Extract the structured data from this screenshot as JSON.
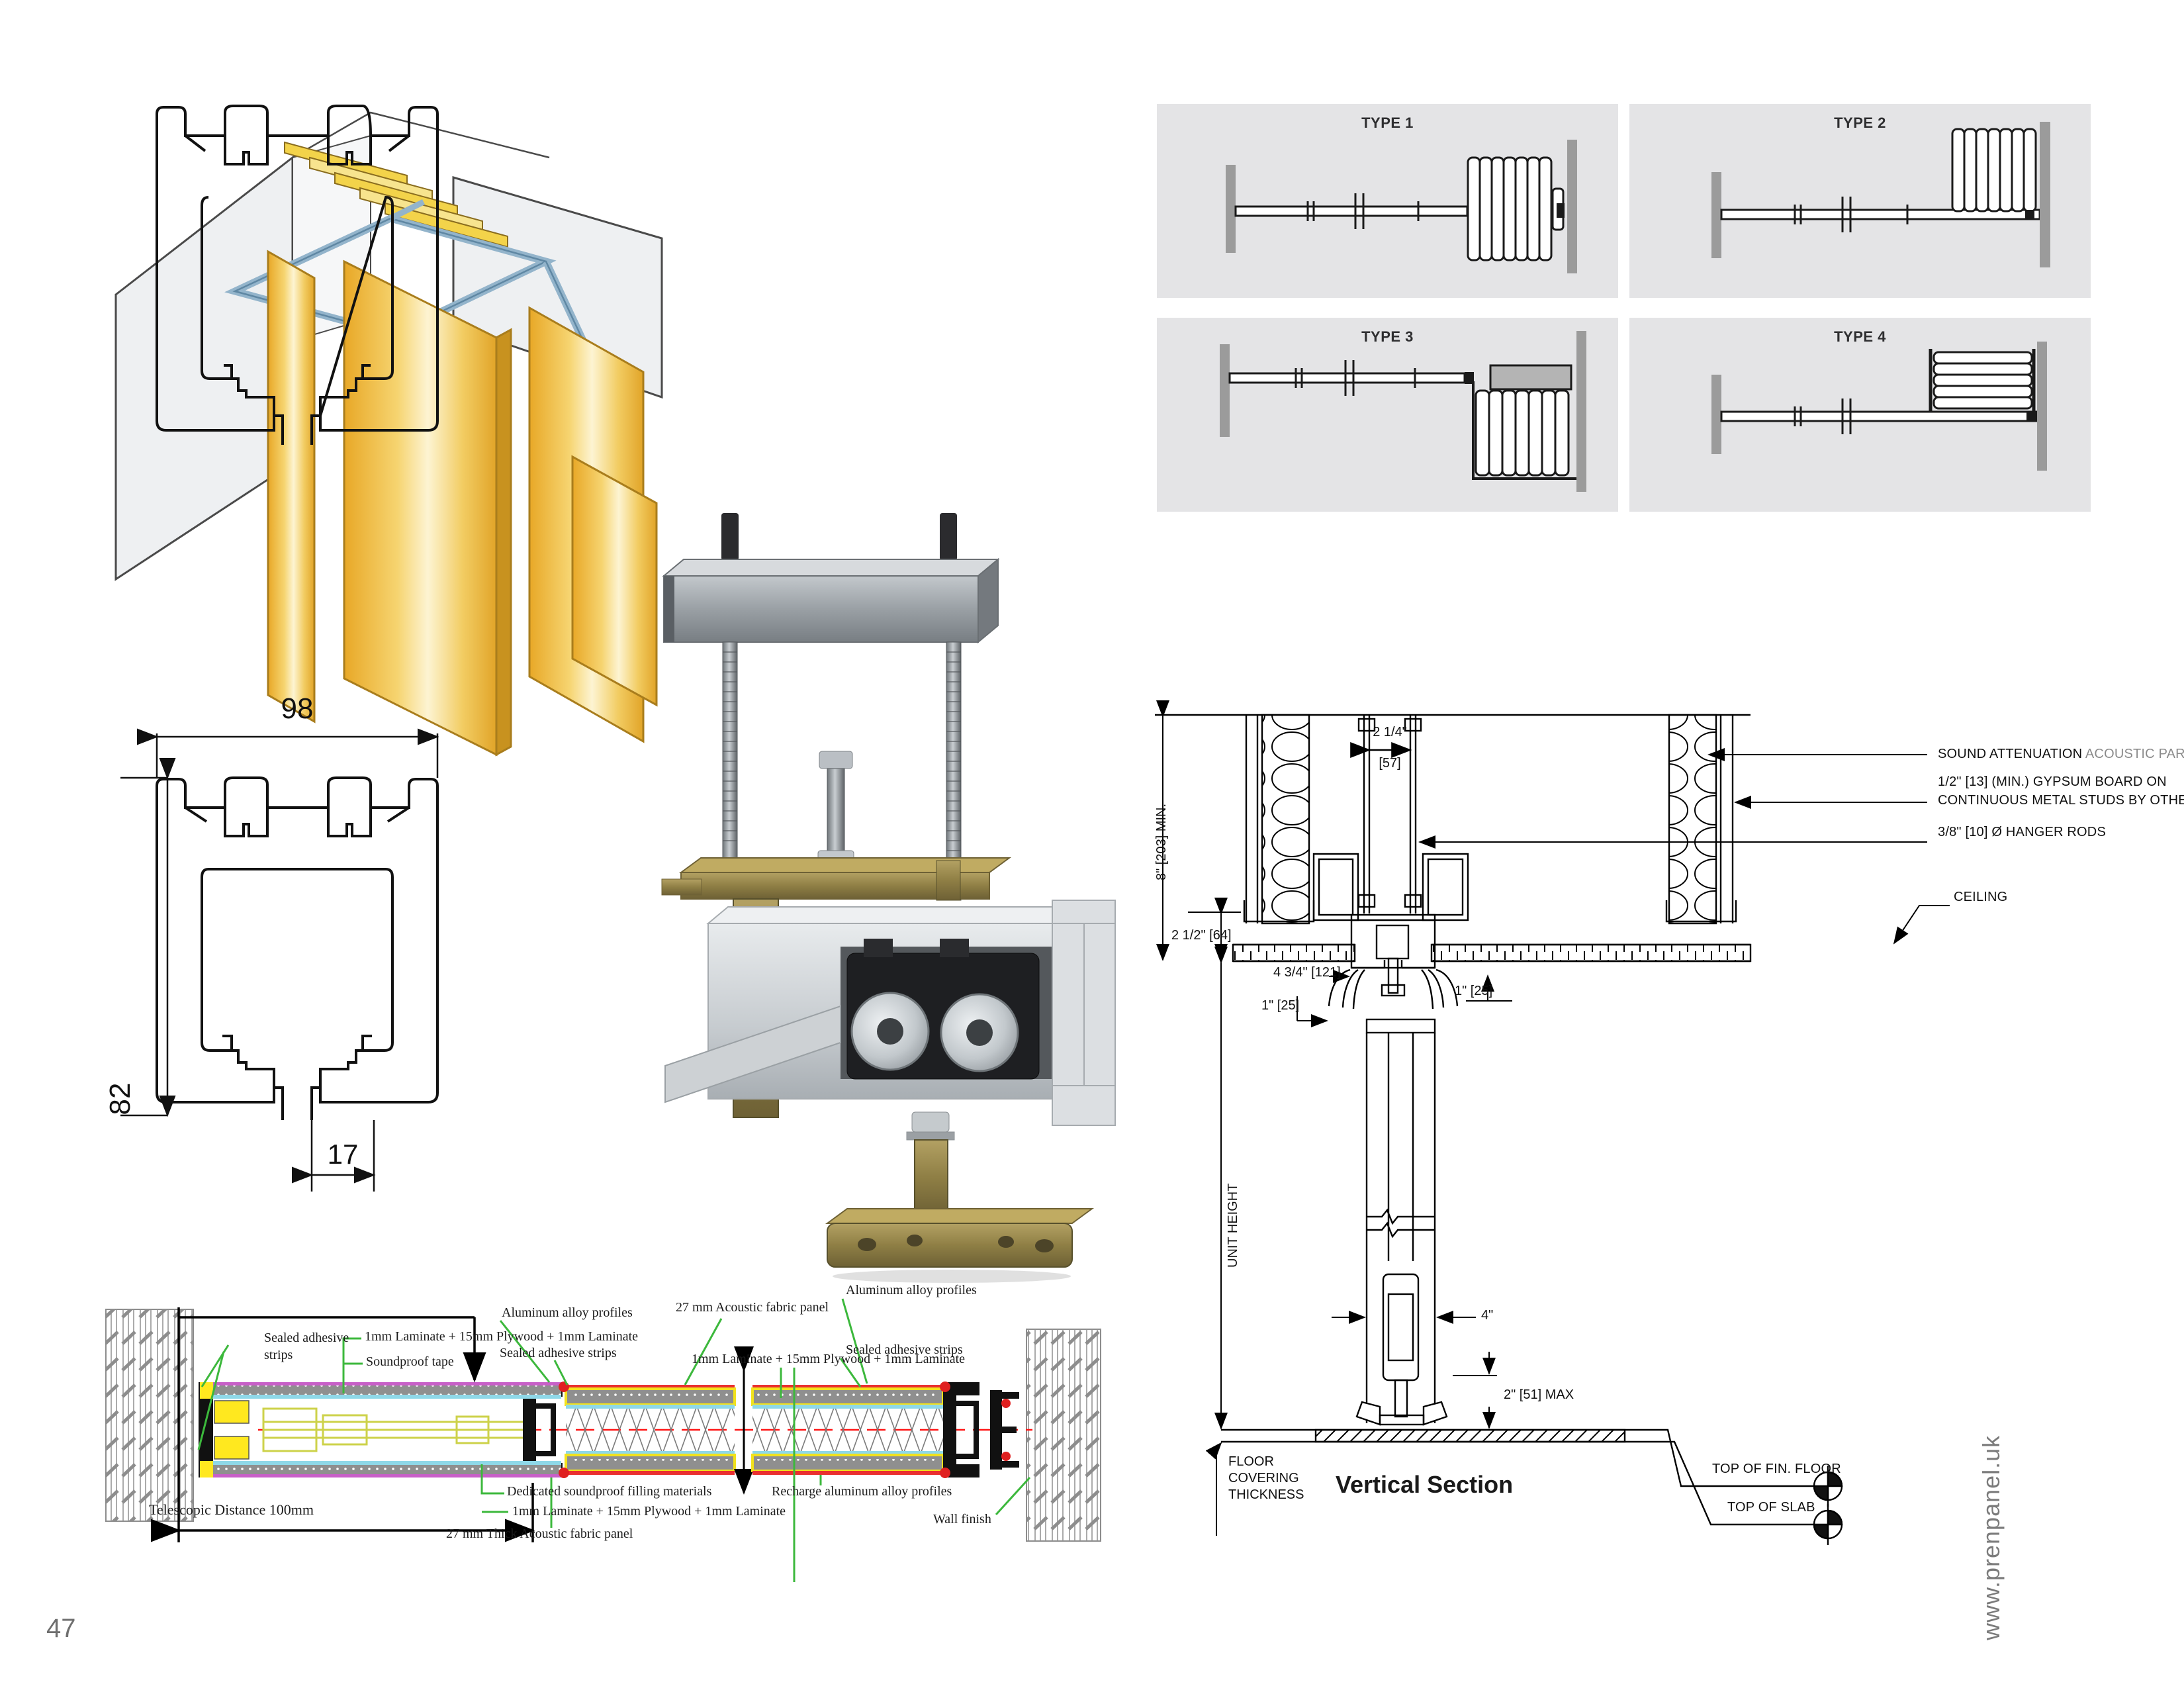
{
  "page": {
    "number": "47",
    "website": "www.prenpanel.uk"
  },
  "types": {
    "t1": "TYPE 1",
    "t2": "TYPE 2",
    "t3": "TYPE 3",
    "t4": "TYPE 4"
  },
  "profile": {
    "width": "98",
    "height": "82",
    "slot": "17"
  },
  "vsec": {
    "title": "Vertical Section",
    "dim_gap": "2 1/4\"",
    "dim_gap_mm": "[57]",
    "dim_min": "8\"  [203] MIN.",
    "dim_ceiling": "2 1/2\"  [64]",
    "dim_track": "4 3/4\"  [121]",
    "dim_one_l": "1\"  [25]",
    "dim_one_r": "1\"  [25]",
    "unit_height": "UNIT HEIGHT",
    "dim_panel": "4\"",
    "dim_floor": "2\" [51] MAX",
    "sound_a": "SOUND ATTENUATION",
    "sound_b": "ACOUSTIC PARTITION",
    "gypsum_1": "1/2\" [13] (MIN.) GYPSUM BOARD ON",
    "gypsum_2": "CONTINUOUS METAL STUDS BY OTHERS",
    "hanger": "3/8\"  [10]  Ø HANGER RODS",
    "ceiling": "CEILING",
    "fin_floor": "TOP OF FIN. FLOOR",
    "top_slab": "TOP OF SLAB",
    "cov_1": "FLOOR",
    "cov_2": "COVERING",
    "cov_3": "THICKNESS"
  },
  "hsec": {
    "sealed_l1": "Sealed adhesive",
    "sealed_l2": "strips",
    "laminate_a": "1mm Laminate + 15mm Plywood + 1mm Laminate",
    "tape": "Soundproof tape",
    "alum_c": "Aluminum alloy profiles",
    "sealed_c": "Sealed adhesive strips",
    "fabric_t": "27 mm Acoustic fabric panel",
    "alum_r": "Aluminum alloy profiles",
    "sealed_r": "Sealed adhesive strips",
    "laminate_b": "1mm Laminate + 15mm Plywood + 1mm Laminate",
    "dedicated": "Dedicated soundproof filling materials",
    "laminate_c": "1mm Laminate + 15mm Plywood + 1mm Laminate",
    "fabric_b": "27 mm Thick Acoustic fabric panel",
    "recharge": "Recharge aluminum alloy profiles",
    "wall_finish": "Wall finish",
    "telescopic": "Telescopic Distance 100mm"
  }
}
